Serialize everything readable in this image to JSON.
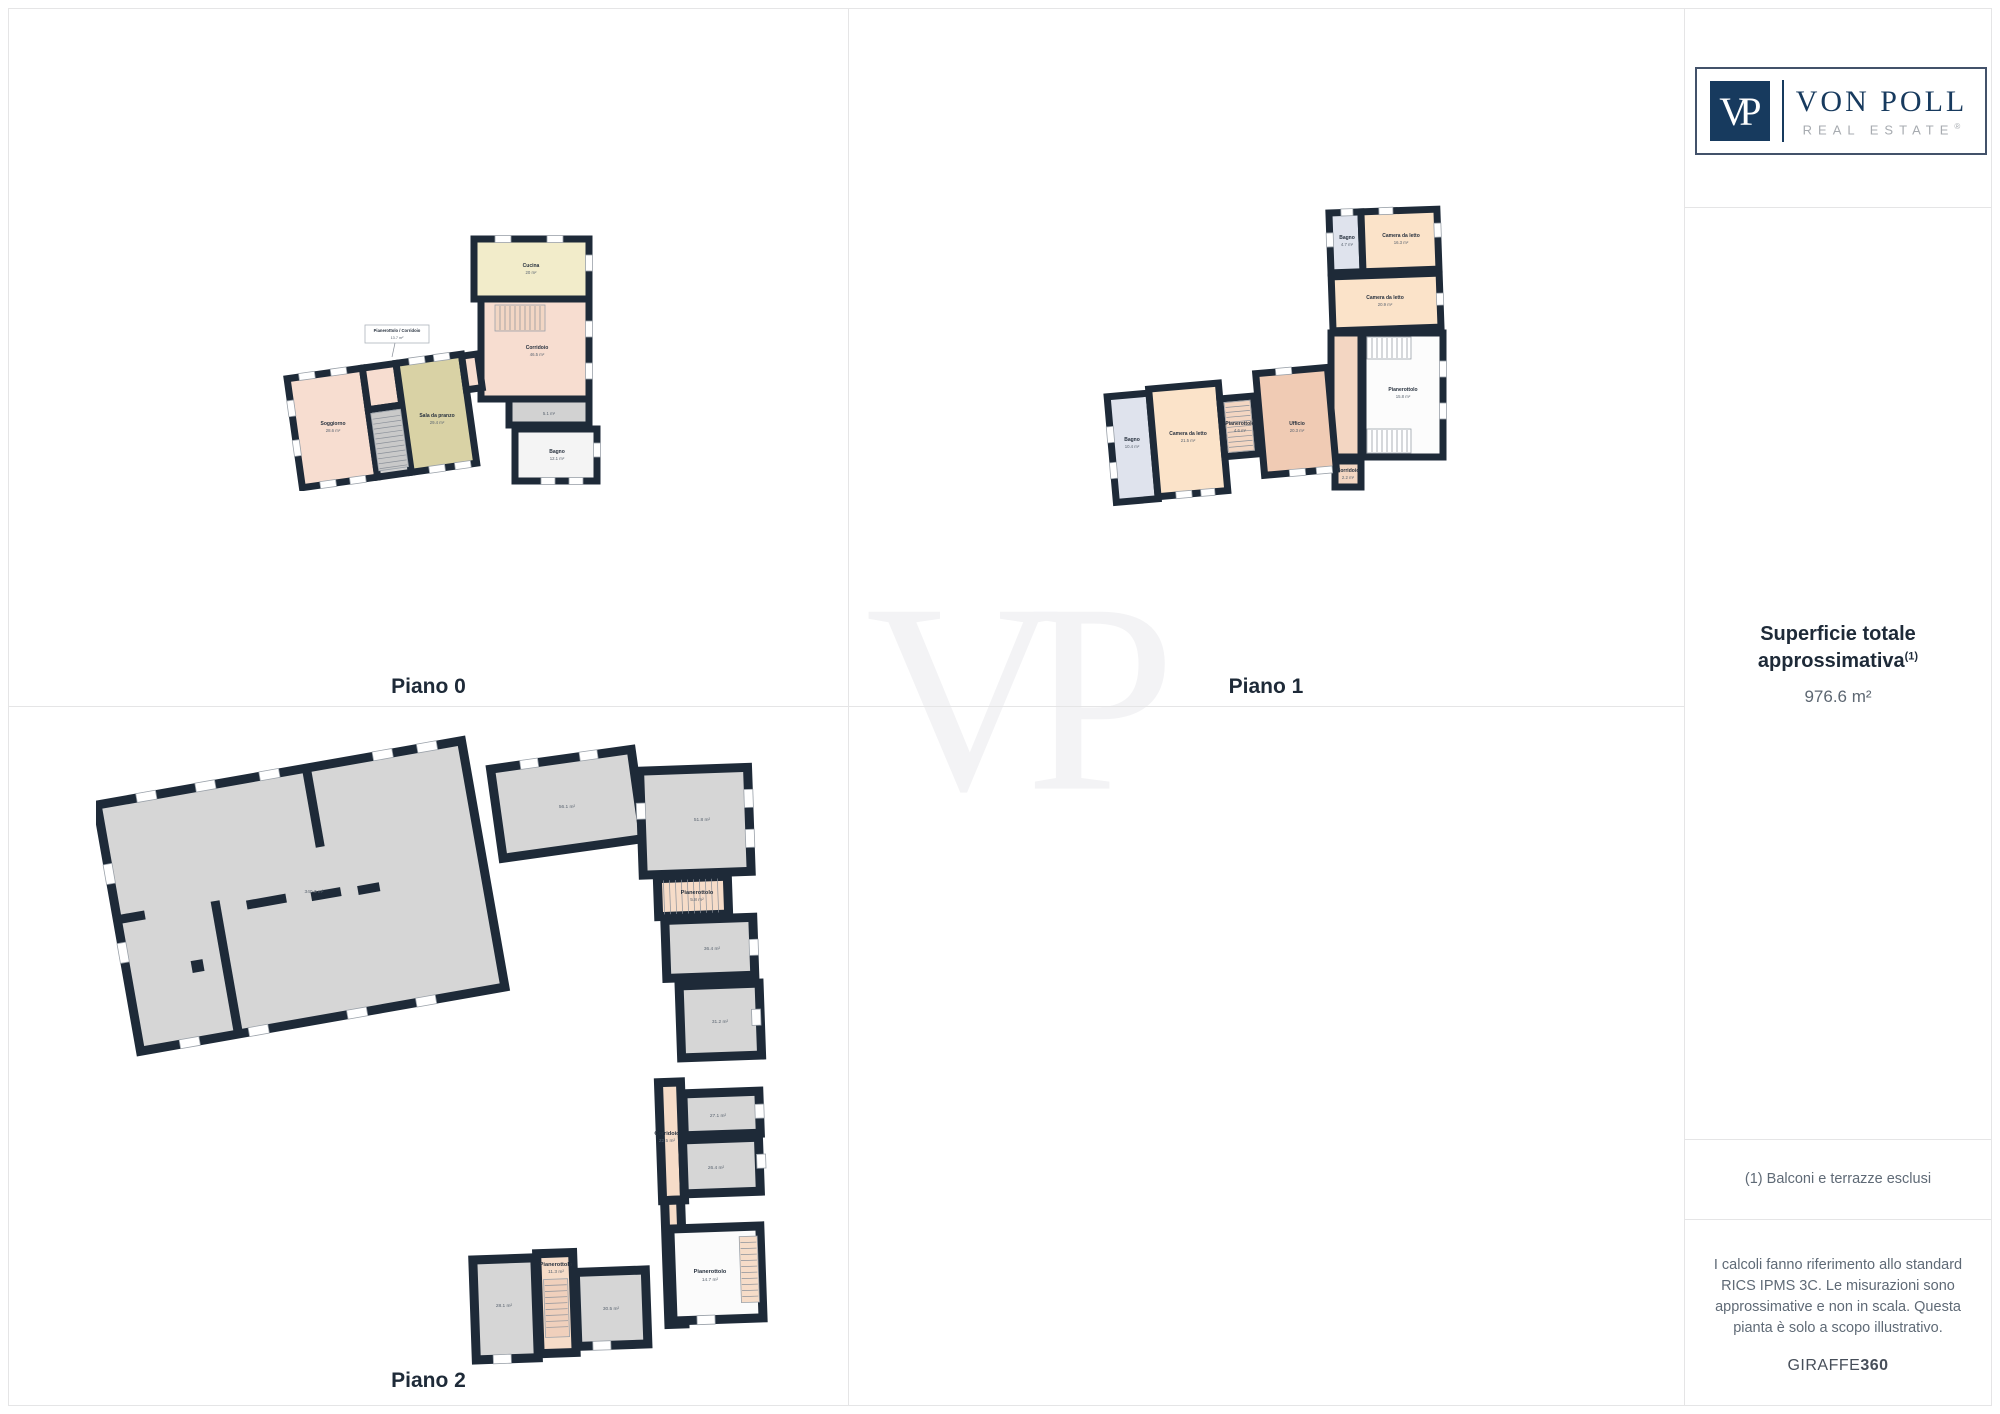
{
  "page": {
    "watermark": "VP"
  },
  "floorplans": {
    "piano0": {
      "title": "Piano 0",
      "rooms": [
        {
          "name": "Soggiorno",
          "area": "28.6 m²"
        },
        {
          "name": "Pianerottolo / Corridoio",
          "area": "13.7 m²"
        },
        {
          "name": "Sala da pranzo",
          "area": "29.4 m²"
        },
        {
          "name": "Cucina",
          "area": "20 m²"
        },
        {
          "name": "Corridoio",
          "area": "46.5 m²"
        },
        {
          "name": "",
          "area": "5.1 m²"
        },
        {
          "name": "Bagno",
          "area": "12.1 m²"
        }
      ]
    },
    "piano1": {
      "title": "Piano 1",
      "rooms": [
        {
          "name": "Bagno",
          "area": "4.7 m²"
        },
        {
          "name": "Camera da letto",
          "area": "16.3 m²"
        },
        {
          "name": "Camera da letto",
          "area": "20.9 m²"
        },
        {
          "name": "Pianerottolo",
          "area": "15.8 m²"
        },
        {
          "name": "Corridoio",
          "area": "2.2 m²"
        },
        {
          "name": "Bagno",
          "area": "10.4 m²"
        },
        {
          "name": "Camera da letto",
          "area": "21.5 m²"
        },
        {
          "name": "Pianerottolo",
          "area": "4.6 m²"
        },
        {
          "name": "Ufficio",
          "area": "20.3 m²"
        }
      ]
    },
    "piano2": {
      "title": "Piano 2",
      "rooms": [
        {
          "name": "",
          "area": "340.3 m²"
        },
        {
          "name": "",
          "area": "56.1 m²"
        },
        {
          "name": "",
          "area": "51.8 m²"
        },
        {
          "name": "Pianerottolo",
          "area": "5.8 m²"
        },
        {
          "name": "",
          "area": "36.4 m²"
        },
        {
          "name": "",
          "area": "31.2 m²"
        },
        {
          "name": "",
          "area": "27.1 m²"
        },
        {
          "name": "Corridoio",
          "area": "22.5 m²"
        },
        {
          "name": "",
          "area": "26.4 m²"
        },
        {
          "name": "Pianerottolo",
          "area": "14.7 m²"
        },
        {
          "name": "",
          "area": "30.5 m²"
        },
        {
          "name": "Pianerottolo",
          "area": "11.3 m²"
        },
        {
          "name": "",
          "area": "28.1 m²"
        }
      ]
    }
  },
  "sidebar": {
    "logo": {
      "monogram": "VP",
      "brand": "VON POLL",
      "subbrand": "REAL ESTATE",
      "registered": "®"
    },
    "summary": {
      "line1": "Superficie totale",
      "line2": "approssimativa",
      "sup": "(1)",
      "value": "976.6 m²"
    },
    "note": "(1) Balconi e terrazze esclusi",
    "disclaimer": "I calcoli fanno riferimento allo standard RICS IPMS 3C. Le misurazioni sono approssimative e non in scala. Questa pianta è solo a scopo illustrativo.",
    "footer_brand": "GIRAFFE",
    "footer_brand_bold": "360"
  }
}
